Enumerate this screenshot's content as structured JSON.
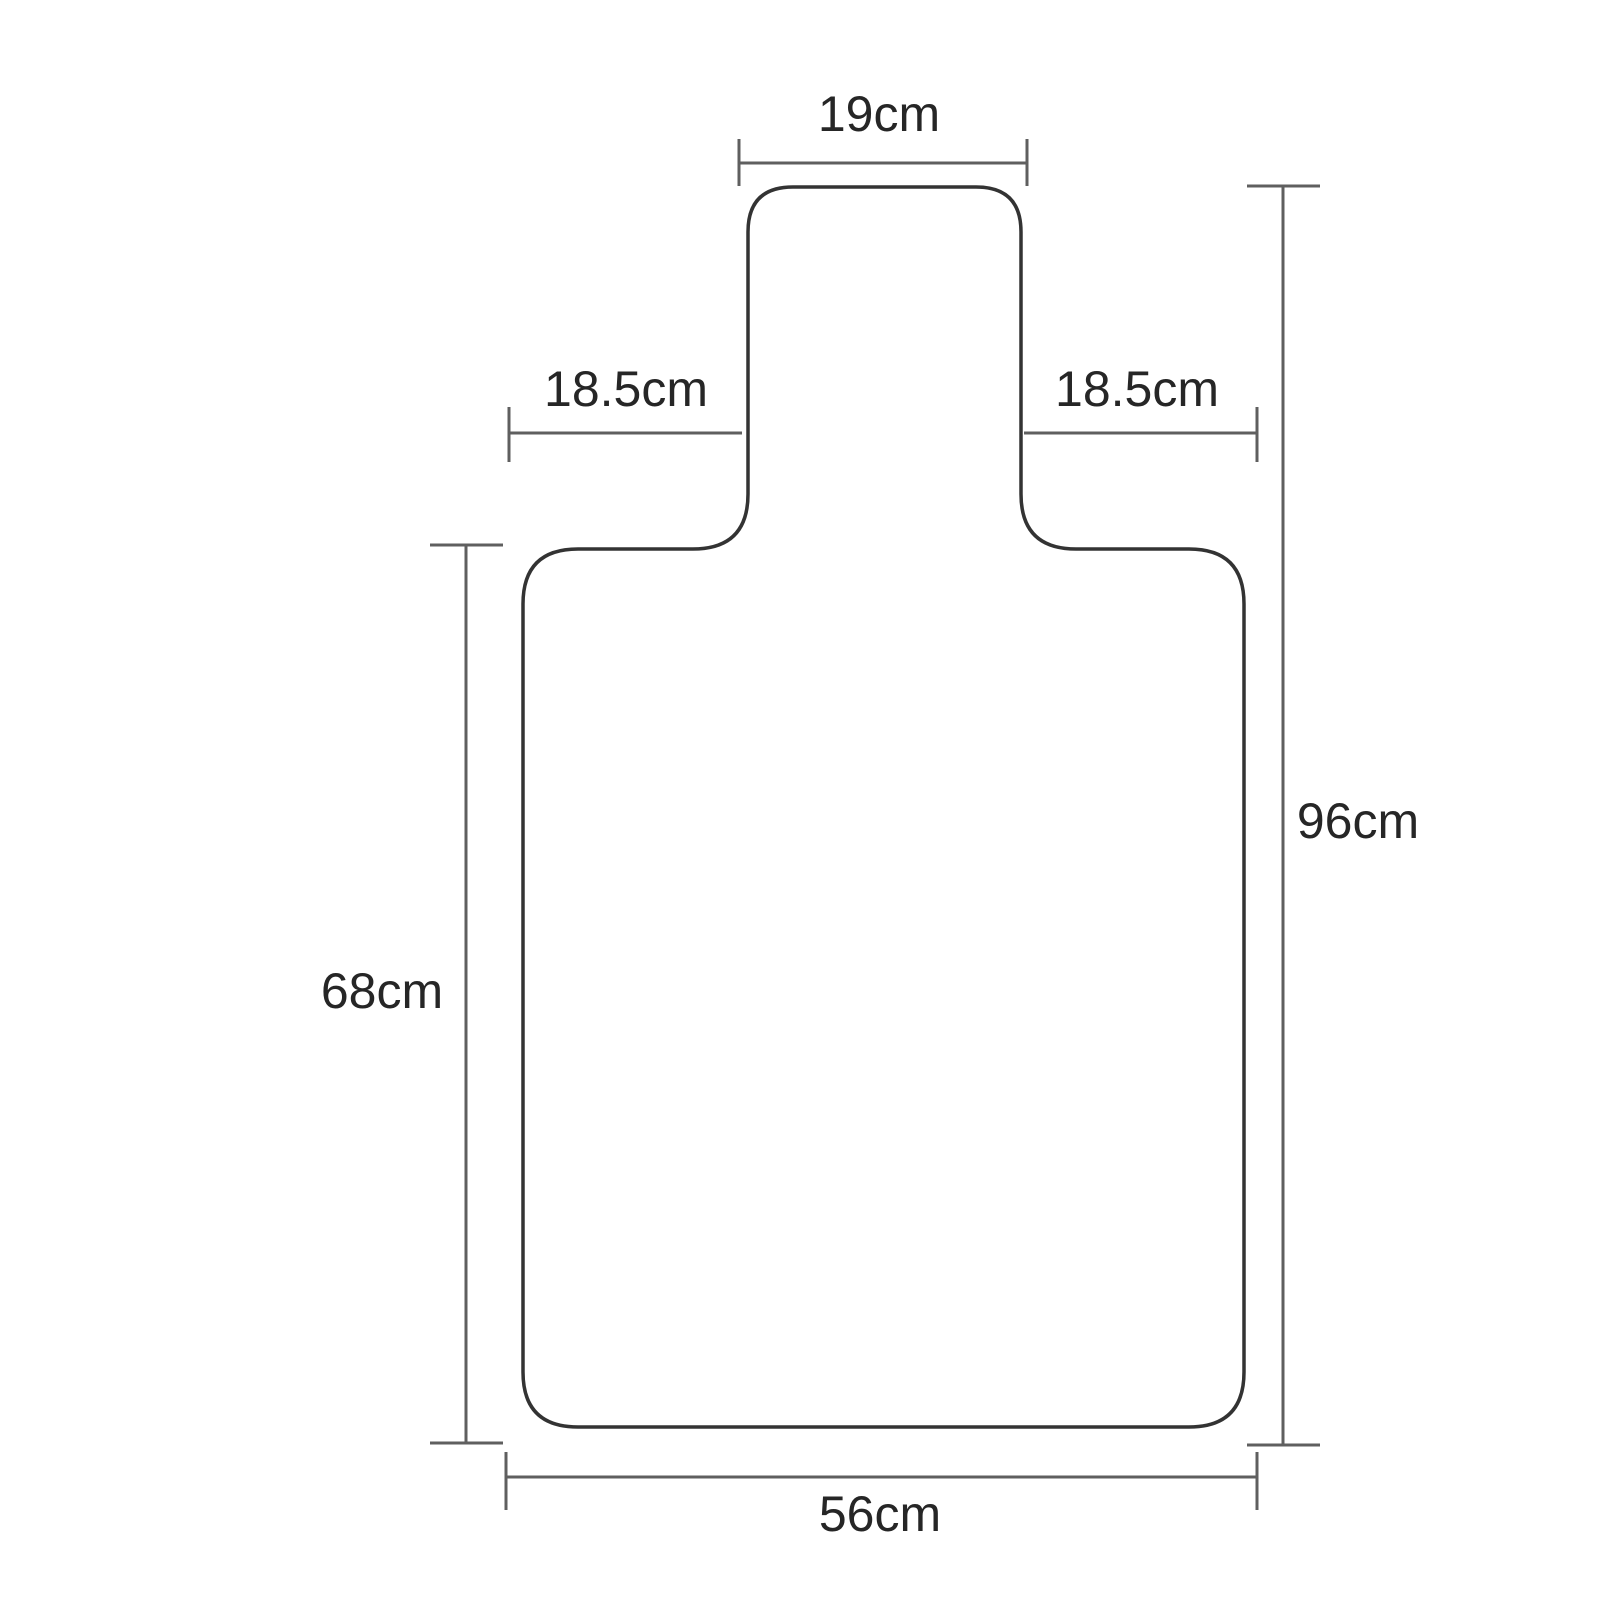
{
  "theme": {
    "background": "#ffffff",
    "outline_color": "#333333",
    "dimension_line_color": "#5f5f5f",
    "label_color": "#262626"
  },
  "diagram": {
    "subject": "chair-mat-with-lip-outline",
    "unit": "cm",
    "dimensions": {
      "tab_width": {
        "label": "19cm",
        "value_cm": 19
      },
      "left_shoulder": {
        "label": "18.5cm",
        "value_cm": 18.5
      },
      "right_shoulder": {
        "label": "18.5cm",
        "value_cm": 18.5
      },
      "overall_height": {
        "label": "96cm",
        "value_cm": 96
      },
      "body_height": {
        "label": "68cm",
        "value_cm": 68
      },
      "body_width": {
        "label": "56cm",
        "value_cm": 56
      }
    }
  }
}
